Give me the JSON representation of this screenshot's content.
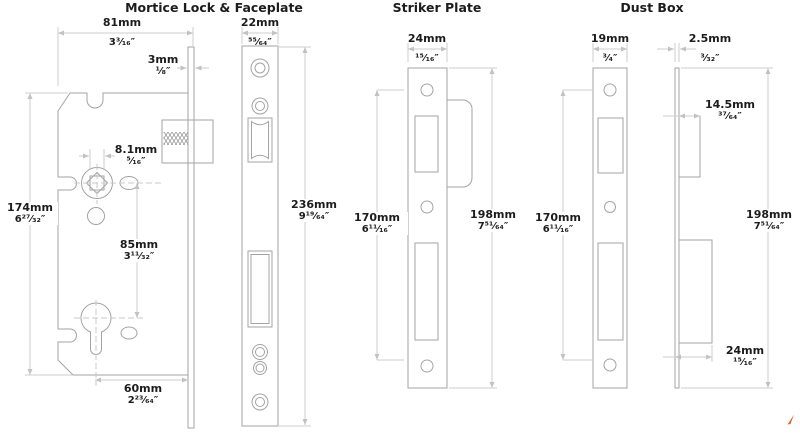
{
  "diagrams": {
    "mortice": {
      "title": "Mortice Lock & Faceplate",
      "dims": {
        "case_width": {
          "mm": "81mm",
          "in": "3³⁄₁₆″"
        },
        "face_thickness": {
          "mm": "3mm",
          "in": "¹⁄₈″"
        },
        "follower_square": {
          "mm": "8.1mm",
          "in": "⁵⁄₁₆″"
        },
        "case_height": {
          "mm": "174mm",
          "in": "6²⁷⁄₃₂″"
        },
        "centres": {
          "mm": "85mm",
          "in": "3¹¹⁄₃₂″"
        },
        "backset": {
          "mm": "60mm",
          "in": "2²³⁄₆₄″"
        },
        "faceplate_width": {
          "mm": "22mm",
          "in": "⁵⁵⁄₆₄″"
        },
        "faceplate_height": {
          "mm": "236mm",
          "in": "9¹⁹⁄₆₄″"
        }
      }
    },
    "striker": {
      "title": "Striker Plate",
      "dims": {
        "width": {
          "mm": "24mm",
          "in": "¹⁵⁄₁₆″"
        },
        "hole_centres": {
          "mm": "170mm",
          "in": "6¹¹⁄₁₆″"
        },
        "total_height": {
          "mm": "198mm",
          "in": "7⁵¹⁄₆₄″"
        }
      }
    },
    "dustbox": {
      "title": "Dust Box",
      "dims": {
        "width": {
          "mm": "19mm",
          "in": "³⁄₄″"
        },
        "plate_thickness": {
          "mm": "2.5mm",
          "in": "³⁄₃₂″"
        },
        "latch_box_depth": {
          "mm": "14.5mm",
          "in": "³⁷⁄₆₄″"
        },
        "hole_centres": {
          "mm": "170mm",
          "in": "6¹¹⁄₁₆″"
        },
        "total_height": {
          "mm": "198mm",
          "in": "7⁵¹⁄₆₄″"
        },
        "bolt_box_depth": {
          "mm": "24mm",
          "in": "¹⁵⁄₁₆″"
        }
      }
    }
  },
  "colors": {
    "part_outline": "#a3a3a3",
    "dimension_line": "#cdcdcd",
    "label_text": "#1c1c1c",
    "brand_mark": "#d96b2e"
  }
}
